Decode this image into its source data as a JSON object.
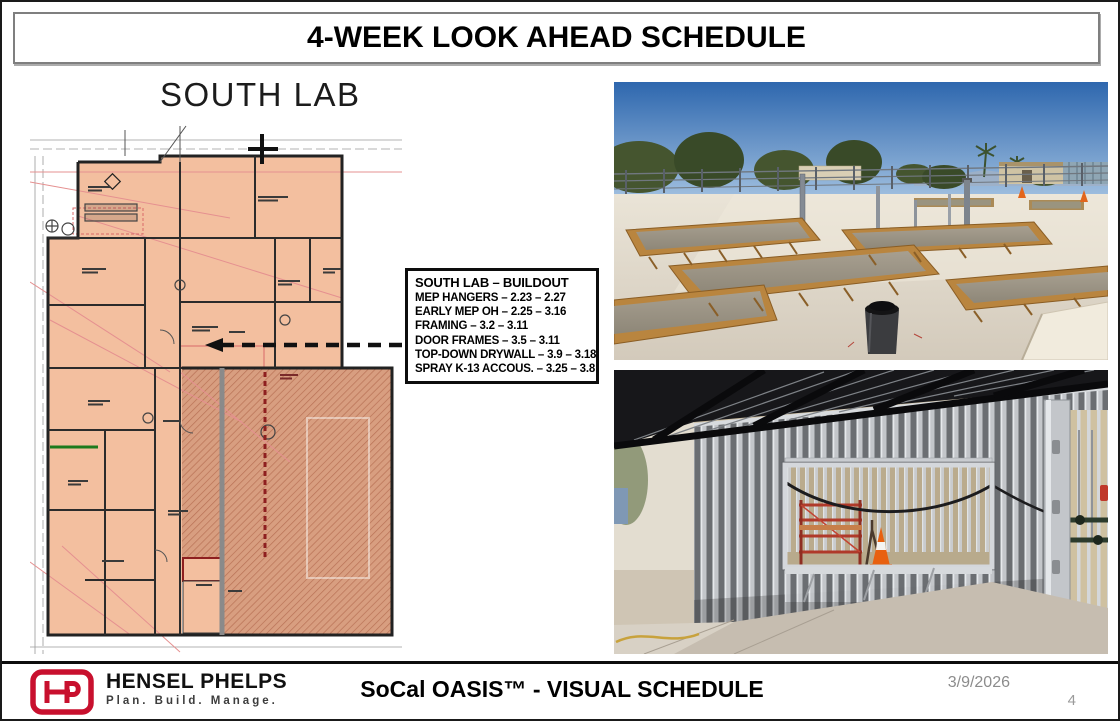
{
  "slide": {
    "title": "4-WEEK LOOK AHEAD SCHEDULE",
    "date": "3/9/2026",
    "page_number": "4"
  },
  "floor_plan": {
    "label": "SOUTH LAB"
  },
  "callout": {
    "title": "SOUTH LAB – BUILDOUT",
    "items": [
      "MEP HANGERS – 2.23 – 2.27",
      "EARLY MEP OH – 2.25 – 3.16",
      "FRAMING – 3.2 – 3.11",
      "DOOR FRAMES – 3.5 – 3.11",
      "TOP-DOWN DRYWALL – 3.9 – 3.18",
      "SPRAY K-13 ACCOUS. – 3.25 – 3.8"
    ]
  },
  "footer": {
    "logo_text": "HP",
    "company": "HENSEL PHELPS",
    "tagline": "Plan. Build. Manage.",
    "project": "SoCal OASIS™ - VISUAL SCHEDULE"
  },
  "colors": {
    "brand_red": "#C8102E",
    "plan_room_fill": "#F3BF9F",
    "plan_hatch_fill": "#D89E80",
    "annotation_red": "#E59090",
    "muted_text": "#8C8C8C"
  }
}
